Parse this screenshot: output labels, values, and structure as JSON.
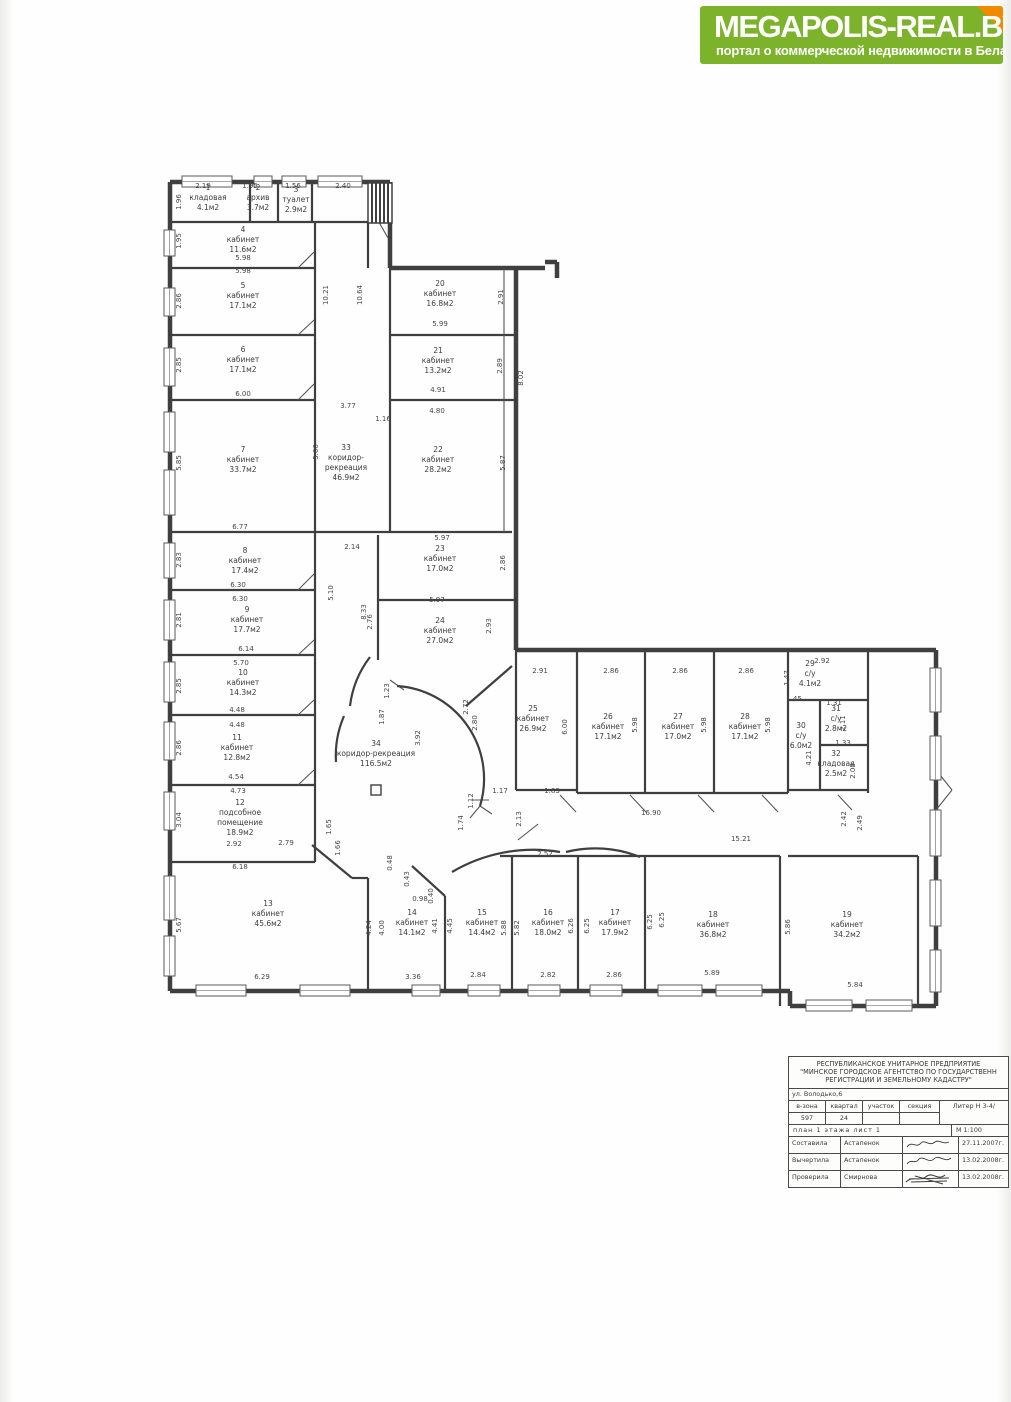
{
  "logo": {
    "title": "MEGAPOLIS-REAL.BY",
    "subtitle": "портал о коммерческой недвижимости в Беларуси",
    "bg_color": "#7cb32b",
    "fold_color": "#f28a00"
  },
  "plan": {
    "rooms": [
      {
        "x": 208,
        "y": 190,
        "lines": [
          "1",
          "кладовая",
          "4.1м2"
        ]
      },
      {
        "x": 258,
        "y": 190,
        "lines": [
          "2",
          "архив",
          "3.7м2"
        ]
      },
      {
        "x": 296,
        "y": 192,
        "lines": [
          "3",
          "туалет",
          "2.9м2"
        ]
      },
      {
        "x": 243,
        "y": 232,
        "lines": [
          "4",
          "кабинет",
          "11.6м2"
        ]
      },
      {
        "x": 243,
        "y": 288,
        "lines": [
          "5",
          "кабинет",
          "17.1м2"
        ]
      },
      {
        "x": 243,
        "y": 352,
        "lines": [
          "6",
          "кабинет",
          "17.1м2"
        ]
      },
      {
        "x": 243,
        "y": 452,
        "lines": [
          "7",
          "кабинет",
          "33.7м2"
        ]
      },
      {
        "x": 245,
        "y": 553,
        "lines": [
          "8",
          "кабинет",
          "17.4м2"
        ]
      },
      {
        "x": 247,
        "y": 612,
        "lines": [
          "9",
          "кабинет",
          "17.7м2"
        ]
      },
      {
        "x": 243,
        "y": 675,
        "lines": [
          "10",
          "кабинет",
          "14.3м2"
        ]
      },
      {
        "x": 237,
        "y": 740,
        "lines": [
          "11",
          "кабинет",
          "12.8м2"
        ]
      },
      {
        "x": 240,
        "y": 805,
        "lines": [
          "12",
          "подсобное",
          "помещение",
          "18.9м2"
        ]
      },
      {
        "x": 268,
        "y": 906,
        "lines": [
          "13",
          "кабинет",
          "45.6м2"
        ]
      },
      {
        "x": 412,
        "y": 915,
        "lines": [
          "14",
          "кабинет",
          "14.1м2"
        ]
      },
      {
        "x": 482,
        "y": 915,
        "lines": [
          "15",
          "кабинет",
          "14.4м2"
        ]
      },
      {
        "x": 548,
        "y": 915,
        "lines": [
          "16",
          "кабинет",
          "18.0м2"
        ]
      },
      {
        "x": 615,
        "y": 915,
        "lines": [
          "17",
          "кабинет",
          "17.9м2"
        ]
      },
      {
        "x": 713,
        "y": 917,
        "lines": [
          "18",
          "кабинет",
          "36.8м2"
        ]
      },
      {
        "x": 847,
        "y": 917,
        "lines": [
          "19",
          "кабинет",
          "34.2м2"
        ]
      },
      {
        "x": 440,
        "y": 286,
        "lines": [
          "20",
          "кабинет",
          "16.8м2"
        ]
      },
      {
        "x": 438,
        "y": 353,
        "lines": [
          "21",
          "кабинет",
          "13.2м2"
        ]
      },
      {
        "x": 438,
        "y": 452,
        "lines": [
          "22",
          "кабинет",
          "28.2м2"
        ]
      },
      {
        "x": 440,
        "y": 551,
        "lines": [
          "23",
          "кабинет",
          "17.0м2"
        ]
      },
      {
        "x": 440,
        "y": 623,
        "lines": [
          "24",
          "кабинет",
          "27.0м2"
        ]
      },
      {
        "x": 533,
        "y": 711,
        "lines": [
          "25",
          "кабинет",
          "26.9м2"
        ]
      },
      {
        "x": 608,
        "y": 719,
        "lines": [
          "26",
          "кабинет",
          "17.1м2"
        ]
      },
      {
        "x": 678,
        "y": 719,
        "lines": [
          "27",
          "кабинет",
          "17.0м2"
        ]
      },
      {
        "x": 745,
        "y": 719,
        "lines": [
          "28",
          "кабинет",
          "17.1м2"
        ]
      },
      {
        "x": 810,
        "y": 666,
        "lines": [
          "29",
          "с/у",
          "4.1м2"
        ]
      },
      {
        "x": 801,
        "y": 728,
        "lines": [
          "30",
          "с/у",
          "6.0м2"
        ]
      },
      {
        "x": 836,
        "y": 711,
        "lines": [
          "31",
          "с/у",
          "2.8м2"
        ]
      },
      {
        "x": 836,
        "y": 756,
        "lines": [
          "32",
          "кладовая",
          "2.5м2"
        ]
      },
      {
        "x": 346,
        "y": 450,
        "lines": [
          "33",
          "коридор-",
          "рекреация",
          "46.9м2"
        ]
      },
      {
        "x": 376,
        "y": 746,
        "lines": [
          "34",
          "коридор-рекреация",
          "116.5м2"
        ]
      }
    ],
    "dims": [
      {
        "t": "2.19",
        "x": 203,
        "y": 188
      },
      {
        "t": "1.95",
        "x": 250,
        "y": 188
      },
      {
        "t": "1.56",
        "x": 293,
        "y": 188
      },
      {
        "t": "2.40",
        "x": 343,
        "y": 188
      },
      {
        "t": "1.96",
        "x": 181,
        "y": 202,
        "r": 1
      },
      {
        "t": "1.95",
        "x": 181,
        "y": 241,
        "r": 1
      },
      {
        "t": "2.86",
        "x": 181,
        "y": 301,
        "r": 1
      },
      {
        "t": "2.85",
        "x": 181,
        "y": 365,
        "r": 1
      },
      {
        "t": "5.85",
        "x": 181,
        "y": 463,
        "r": 1
      },
      {
        "t": "2.83",
        "x": 181,
        "y": 560,
        "r": 1
      },
      {
        "t": "2.81",
        "x": 181,
        "y": 620,
        "r": 1
      },
      {
        "t": "2.85",
        "x": 181,
        "y": 686,
        "r": 1
      },
      {
        "t": "2.86",
        "x": 181,
        "y": 748,
        "r": 1
      },
      {
        "t": "3.04",
        "x": 181,
        "y": 820,
        "r": 1
      },
      {
        "t": "5.67",
        "x": 181,
        "y": 925,
        "r": 1
      },
      {
        "t": "5.98",
        "x": 243,
        "y": 260
      },
      {
        "t": "5.98",
        "x": 243,
        "y": 273
      },
      {
        "t": "6.00",
        "x": 243,
        "y": 396
      },
      {
        "t": "6.77",
        "x": 240,
        "y": 529
      },
      {
        "t": "6.30",
        "x": 238,
        "y": 587
      },
      {
        "t": "6.30",
        "x": 240,
        "y": 601
      },
      {
        "t": "6.14",
        "x": 246,
        "y": 651
      },
      {
        "t": "5.70",
        "x": 241,
        "y": 665
      },
      {
        "t": "4.48",
        "x": 237,
        "y": 712
      },
      {
        "t": "4.48",
        "x": 237,
        "y": 727
      },
      {
        "t": "4.54",
        "x": 236,
        "y": 779
      },
      {
        "t": "4.73",
        "x": 238,
        "y": 793
      },
      {
        "t": "2.92",
        "x": 234,
        "y": 846
      },
      {
        "t": "2.79",
        "x": 286,
        "y": 845
      },
      {
        "t": "6.18",
        "x": 240,
        "y": 869
      },
      {
        "t": "6.29",
        "x": 262,
        "y": 979
      },
      {
        "t": "10.21",
        "x": 328,
        "y": 295,
        "r": 1
      },
      {
        "t": "10.64",
        "x": 362,
        "y": 295,
        "r": 1
      },
      {
        "t": "5.99",
        "x": 440,
        "y": 326
      },
      {
        "t": "2.91",
        "x": 503,
        "y": 297,
        "r": 1
      },
      {
        "t": "4.91",
        "x": 438,
        "y": 392
      },
      {
        "t": "2.89",
        "x": 502,
        "y": 366,
        "r": 1
      },
      {
        "t": "8.02",
        "x": 523,
        "y": 378,
        "r": 1
      },
      {
        "t": "4.80",
        "x": 437,
        "y": 413
      },
      {
        "t": "5.87",
        "x": 505,
        "y": 463,
        "r": 1
      },
      {
        "t": "3.77",
        "x": 348,
        "y": 408
      },
      {
        "t": "1.16",
        "x": 383,
        "y": 421
      },
      {
        "t": "2.14",
        "x": 352,
        "y": 549
      },
      {
        "t": "5.66",
        "x": 318,
        "y": 452,
        "r": 1
      },
      {
        "t": "5.97",
        "x": 442,
        "y": 540
      },
      {
        "t": "2.86",
        "x": 505,
        "y": 563,
        "r": 1
      },
      {
        "t": "5.97",
        "x": 437,
        "y": 602
      },
      {
        "t": "2.93",
        "x": 491,
        "y": 626,
        "r": 1
      },
      {
        "t": "2.76",
        "x": 372,
        "y": 622,
        "r": 1
      },
      {
        "t": "5.10",
        "x": 333,
        "y": 593,
        "r": 1
      },
      {
        "t": "8.33",
        "x": 366,
        "y": 612,
        "r": 1
      },
      {
        "t": "1.23",
        "x": 389,
        "y": 691,
        "r": 1
      },
      {
        "t": "1.87",
        "x": 384,
        "y": 717,
        "r": 1
      },
      {
        "t": "2.72",
        "x": 468,
        "y": 707,
        "r": 1
      },
      {
        "t": "2.80",
        "x": 477,
        "y": 723,
        "r": 1
      },
      {
        "t": "3.92",
        "x": 420,
        "y": 738,
        "r": 1
      },
      {
        "t": "1.12",
        "x": 473,
        "y": 801,
        "r": 1
      },
      {
        "t": "1.74",
        "x": 463,
        "y": 823,
        "r": 1
      },
      {
        "t": "1.17",
        "x": 500,
        "y": 793
      },
      {
        "t": "1.83",
        "x": 552,
        "y": 793
      },
      {
        "t": "2.13",
        "x": 521,
        "y": 819,
        "r": 1
      },
      {
        "t": "2.91",
        "x": 540,
        "y": 673
      },
      {
        "t": "2.86",
        "x": 611,
        "y": 673
      },
      {
        "t": "2.86",
        "x": 680,
        "y": 673
      },
      {
        "t": "2.86",
        "x": 746,
        "y": 673
      },
      {
        "t": "6.00",
        "x": 567,
        "y": 727,
        "r": 1
      },
      {
        "t": "5.98",
        "x": 637,
        "y": 725,
        "r": 1
      },
      {
        "t": "5.98",
        "x": 706,
        "y": 725,
        "r": 1
      },
      {
        "t": "5.98",
        "x": 770,
        "y": 725,
        "r": 1
      },
      {
        "t": "16.90",
        "x": 651,
        "y": 815
      },
      {
        "t": "15.21",
        "x": 741,
        "y": 841
      },
      {
        "t": "1.47",
        "x": 789,
        "y": 678,
        "r": 1
      },
      {
        "t": "2.92",
        "x": 822,
        "y": 663
      },
      {
        "t": "1.45",
        "x": 794,
        "y": 701
      },
      {
        "t": "1.31",
        "x": 834,
        "y": 705
      },
      {
        "t": "2.11",
        "x": 845,
        "y": 723,
        "r": 1
      },
      {
        "t": "4.21",
        "x": 811,
        "y": 758,
        "r": 1
      },
      {
        "t": "1.33",
        "x": 843,
        "y": 745
      },
      {
        "t": "2.08",
        "x": 855,
        "y": 771,
        "r": 1
      },
      {
        "t": "2.42",
        "x": 846,
        "y": 819,
        "r": 1
      },
      {
        "t": "2.49",
        "x": 862,
        "y": 823,
        "r": 1
      },
      {
        "t": "2.52",
        "x": 545,
        "y": 856
      },
      {
        "t": "0.48",
        "x": 392,
        "y": 863,
        "r": 1
      },
      {
        "t": "0.43",
        "x": 409,
        "y": 879,
        "r": 1
      },
      {
        "t": "0.98",
        "x": 420,
        "y": 901
      },
      {
        "t": "0.40",
        "x": 433,
        "y": 896,
        "r": 1
      },
      {
        "t": "1.65",
        "x": 331,
        "y": 827,
        "r": 1
      },
      {
        "t": "1.66",
        "x": 340,
        "y": 848,
        "r": 1
      },
      {
        "t": "4.24",
        "x": 371,
        "y": 928,
        "r": 1
      },
      {
        "t": "4.00",
        "x": 384,
        "y": 928,
        "r": 1
      },
      {
        "t": "4.41",
        "x": 437,
        "y": 926,
        "r": 1
      },
      {
        "t": "4.45",
        "x": 452,
        "y": 926,
        "r": 1
      },
      {
        "t": "5.88",
        "x": 506,
        "y": 928,
        "r": 1
      },
      {
        "t": "5.82",
        "x": 519,
        "y": 928,
        "r": 1
      },
      {
        "t": "6.26",
        "x": 573,
        "y": 926,
        "r": 1
      },
      {
        "t": "6.25",
        "x": 589,
        "y": 926,
        "r": 1
      },
      {
        "t": "6.25",
        "x": 652,
        "y": 922,
        "r": 1
      },
      {
        "t": "6.25",
        "x": 664,
        "y": 920,
        "r": 1
      },
      {
        "t": "5.86",
        "x": 790,
        "y": 927,
        "r": 1
      },
      {
        "t": "3.36",
        "x": 413,
        "y": 979
      },
      {
        "t": "2.84",
        "x": 478,
        "y": 977
      },
      {
        "t": "2.82",
        "x": 548,
        "y": 977
      },
      {
        "t": "2.86",
        "x": 614,
        "y": 977
      },
      {
        "t": "5.89",
        "x": 712,
        "y": 975
      },
      {
        "t": "5.84",
        "x": 855,
        "y": 987
      }
    ]
  },
  "title_block": {
    "org_line1": "РЕСПУБЛИКАНСКОЕ УНИТАРНОЕ ПРЕДПРИЯТИЕ",
    "org_line2": "\"МИНСКОЕ ГОРОДСКОЕ АГЕНТСТВО ПО ГОСУДАРСТВЕНН",
    "org_line3": "РЕГИСТРАЦИИ И ЗЕМЕЛЬНОМУ КАДАСТРУ\"",
    "address": "ул. Володько,6",
    "grid_headers": [
      "в-зона",
      "квартал",
      "участок",
      "секция"
    ],
    "grid_values": [
      "597",
      "24",
      "",
      ""
    ],
    "liter": "Литер Н 3-4/",
    "plan_sheet": "план 1 этажа    лист 1",
    "scale": "М 1:100",
    "sign_rows": [
      {
        "role": "Составила",
        "name": "Астапенок",
        "date": "27.11.2007г."
      },
      {
        "role": "Вычертила",
        "name": "Астапенок",
        "date": "13.02.2008г."
      },
      {
        "role": "Проверила",
        "name": "Смирнова",
        "date": "13.02.2008г."
      }
    ]
  }
}
